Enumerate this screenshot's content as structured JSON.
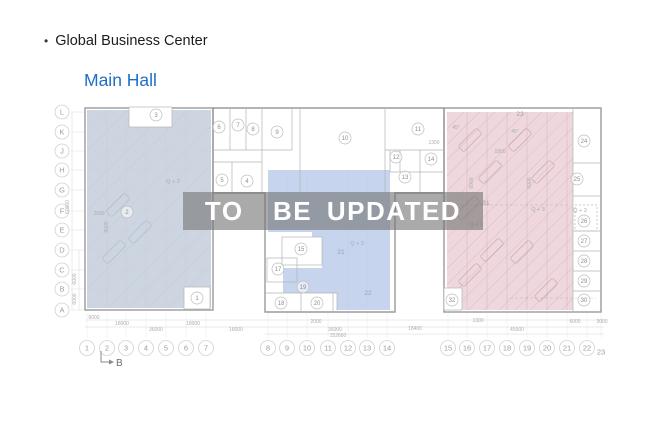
{
  "page": {
    "bullet": "•",
    "title": "Global Business Center",
    "subtitle": "Main Hall",
    "watermark": "TO  BE UPDATED"
  },
  "colors": {
    "subtitle_blue": "#1e6ec8",
    "region_left": "#cdd5e0",
    "region_mid": "#c6d4ee",
    "region_pink": "#eed7dd",
    "watermark_bg": "rgba(118,118,118,0.62)",
    "watermark_text": "#ffffff"
  },
  "plan": {
    "marker_b": "B",
    "row_labels": [
      {
        "l": "L",
        "y": 112
      },
      {
        "l": "K",
        "y": 132
      },
      {
        "l": "J",
        "y": 151
      },
      {
        "l": "H",
        "y": 170
      },
      {
        "l": "G",
        "y": 190
      },
      {
        "l": "F",
        "y": 211
      },
      {
        "l": "E",
        "y": 230
      },
      {
        "l": "D",
        "y": 250
      },
      {
        "l": "C",
        "y": 270
      },
      {
        "l": "B",
        "y": 289
      },
      {
        "l": "A",
        "y": 310
      }
    ],
    "column_labels": [
      {
        "l": "1",
        "x": 87
      },
      {
        "l": "2",
        "x": 107
      },
      {
        "l": "3",
        "x": 126
      },
      {
        "l": "4",
        "x": 146
      },
      {
        "l": "5",
        "x": 166
      },
      {
        "l": "6",
        "x": 186
      },
      {
        "l": "7",
        "x": 206
      },
      {
        "l": "8",
        "x": 268
      },
      {
        "l": "9",
        "x": 287
      },
      {
        "l": "10",
        "x": 307
      },
      {
        "l": "11",
        "x": 328
      },
      {
        "l": "12",
        "x": 348
      },
      {
        "l": "13",
        "x": 367
      },
      {
        "l": "14",
        "x": 387
      },
      {
        "l": "15",
        "x": 448
      },
      {
        "l": "16",
        "x": 467
      },
      {
        "l": "17",
        "x": 487
      },
      {
        "l": "18",
        "x": 507
      },
      {
        "l": "19",
        "x": 527
      },
      {
        "l": "20",
        "x": 547
      },
      {
        "l": "21",
        "x": 567
      },
      {
        "l": "22",
        "x": 587
      },
      {
        "l": "23",
        "x": 601,
        "plain": true,
        "dy": 4
      }
    ],
    "rooms": [
      {
        "n": "1",
        "x": 197,
        "y": 298,
        "c": true
      },
      {
        "n": "2",
        "x": 127,
        "y": 212,
        "c": true
      },
      {
        "n": "3",
        "x": 156,
        "y": 115,
        "c": true
      },
      {
        "n": "4",
        "x": 247,
        "y": 181,
        "c": true
      },
      {
        "n": "5",
        "x": 222,
        "y": 180,
        "c": true
      },
      {
        "n": "6",
        "x": 219,
        "y": 127,
        "c": true
      },
      {
        "n": "7",
        "x": 238,
        "y": 125,
        "c": true
      },
      {
        "n": "8",
        "x": 253,
        "y": 129,
        "c": true
      },
      {
        "n": "9",
        "x": 277,
        "y": 132,
        "c": true
      },
      {
        "n": "10",
        "x": 345,
        "y": 138,
        "c": true
      },
      {
        "n": "11",
        "x": 418,
        "y": 129,
        "c": true
      },
      {
        "n": "12",
        "x": 396,
        "y": 157,
        "c": true
      },
      {
        "n": "13",
        "x": 405,
        "y": 177,
        "c": true
      },
      {
        "n": "14",
        "x": 431,
        "y": 159,
        "c": true
      },
      {
        "n": "15",
        "x": 301,
        "y": 249,
        "c": true
      },
      {
        "n": "17",
        "x": 278,
        "y": 269,
        "c": true
      },
      {
        "n": "18",
        "x": 281,
        "y": 303,
        "c": true
      },
      {
        "n": "19",
        "x": 303,
        "y": 287,
        "c": true
      },
      {
        "n": "20",
        "x": 317,
        "y": 303,
        "c": true
      },
      {
        "n": "21",
        "x": 341,
        "y": 252,
        "c": false
      },
      {
        "n": "22",
        "x": 368,
        "y": 293,
        "c": false
      },
      {
        "n": "23",
        "x": 520,
        "y": 114,
        "c": false
      },
      {
        "n": "24",
        "x": 584,
        "y": 141,
        "c": true
      },
      {
        "n": "25",
        "x": 577,
        "y": 179,
        "c": true
      },
      {
        "n": "26",
        "x": 584,
        "y": 221,
        "c": true
      },
      {
        "n": "27",
        "x": 584,
        "y": 241,
        "c": true
      },
      {
        "n": "28",
        "x": 584,
        "y": 261,
        "c": true
      },
      {
        "n": "29",
        "x": 584,
        "y": 281,
        "c": true
      },
      {
        "n": "30",
        "x": 584,
        "y": 300,
        "c": true
      },
      {
        "n": "31",
        "x": 486,
        "y": 203,
        "c": false
      },
      {
        "n": "32",
        "x": 452,
        "y": 300,
        "c": true
      }
    ],
    "elevation_labels": [
      {
        "t": "Q + 3",
        "x": 173,
        "y": 183
      },
      {
        "t": "Q + 3",
        "x": 357,
        "y": 245
      },
      {
        "t": "Q + 3",
        "x": 476,
        "y": 226
      },
      {
        "t": "Q + 3",
        "x": 538,
        "y": 211
      },
      {
        "t": "Q + 3",
        "x": 580,
        "y": 212
      }
    ],
    "dimensions": [
      {
        "t": "6000",
        "x": 94,
        "y": 319
      },
      {
        "t": "18000",
        "x": 122,
        "y": 325
      },
      {
        "t": "36000",
        "x": 156,
        "y": 331
      },
      {
        "t": "18000",
        "x": 193,
        "y": 325
      },
      {
        "t": "18000",
        "x": 236,
        "y": 331
      },
      {
        "t": "2000",
        "x": 316,
        "y": 323
      },
      {
        "t": "36000",
        "x": 335,
        "y": 331
      },
      {
        "t": "152660",
        "x": 338,
        "y": 337
      },
      {
        "t": "18400",
        "x": 415,
        "y": 330
      },
      {
        "t": "1300",
        "x": 478,
        "y": 322
      },
      {
        "t": "45000",
        "x": 517,
        "y": 331
      },
      {
        "t": "6000",
        "x": 575,
        "y": 323
      },
      {
        "t": "3000",
        "x": 602,
        "y": 323
      },
      {
        "t": "60000",
        "x": 69,
        "y": 207,
        "r": -90
      },
      {
        "t": "6000",
        "x": 76,
        "y": 279,
        "r": -90
      },
      {
        "t": "6000",
        "x": 76,
        "y": 299,
        "r": -90
      },
      {
        "t": "2600",
        "x": 99,
        "y": 215
      },
      {
        "t": "3000",
        "x": 108,
        "y": 227,
        "r": -90
      },
      {
        "t": "1300",
        "x": 434,
        "y": 144
      },
      {
        "t": "1800",
        "x": 500,
        "y": 153
      },
      {
        "t": "45°",
        "x": 456,
        "y": 129
      },
      {
        "t": "45°",
        "x": 515,
        "y": 133
      },
      {
        "t": "6000",
        "x": 473,
        "y": 183,
        "r": -90
      },
      {
        "t": "6000",
        "x": 531,
        "y": 183,
        "r": -90
      }
    ]
  }
}
